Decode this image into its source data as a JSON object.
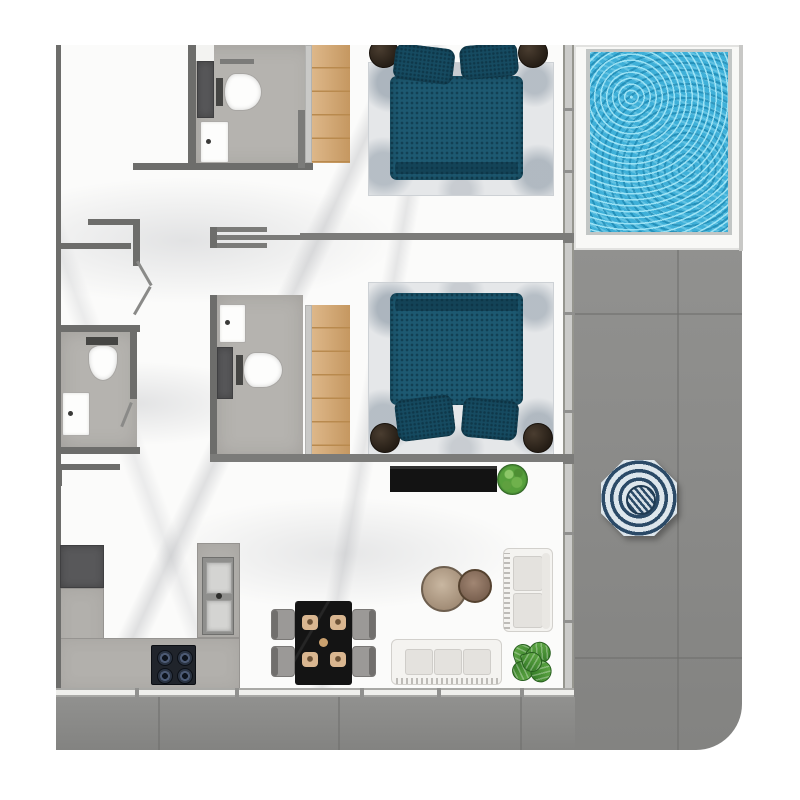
{
  "meta": {
    "title": "Apartment floor plan, top-down 3D render with pool deck",
    "canvas": {
      "width": 800,
      "height": 800
    }
  },
  "palette": {
    "page": "#ffffff",
    "marble": "#fbfbfa",
    "bath-floor": "#b5b3af",
    "wall": "#6d6d6b",
    "wall-mid": "#7b7b79",
    "window-wall": "#cbcbc9",
    "counter": "#b2b0ac",
    "appliance": "#58585a",
    "stove-black": "#20242b",
    "deck": "#8b8b89",
    "deck-joint": "#6f6f6d",
    "pool-water": "#3fb0d8",
    "pool-surround": "#f8f8f6",
    "bed-teal": "#1d5971",
    "pillow-teal": "#164b61",
    "rug": "#e5e7e9",
    "wood": "#d4a368",
    "wood-line": "#b98a4e",
    "sofa": "#f4f3f0",
    "chair": "#9b9997",
    "table-black": "#141414",
    "plate": "#d9b690",
    "fixture-white": "#fdfdfc",
    "umbrella-navy": "#2b4a67",
    "umbrella-white": "#dde6ec",
    "plant-green": "#4f9a3b"
  },
  "inventory": {
    "rooms": [
      "bedroom-top",
      "bedroom-middle",
      "bathroom-top",
      "bathroom-left",
      "bathroom-middle",
      "entry-hallway",
      "kitchen",
      "dining-area",
      "living-area",
      "wraparound-deck",
      "swimming-pool"
    ],
    "furniture_counts": {
      "double-bed": 2,
      "nightstand": 4,
      "wardrobe": 2,
      "toilet": 3,
      "bathroom-sink": 3,
      "kitchen-sink": 1,
      "cooktop-burners": 4,
      "refrigerator": 1,
      "dining-table": 1,
      "dining-chair": 4,
      "place-setting": 4,
      "sofa": 2,
      "coffee-table": 2,
      "tv-console": 1,
      "potted-plant": 2,
      "parasol-umbrella": 1
    }
  }
}
